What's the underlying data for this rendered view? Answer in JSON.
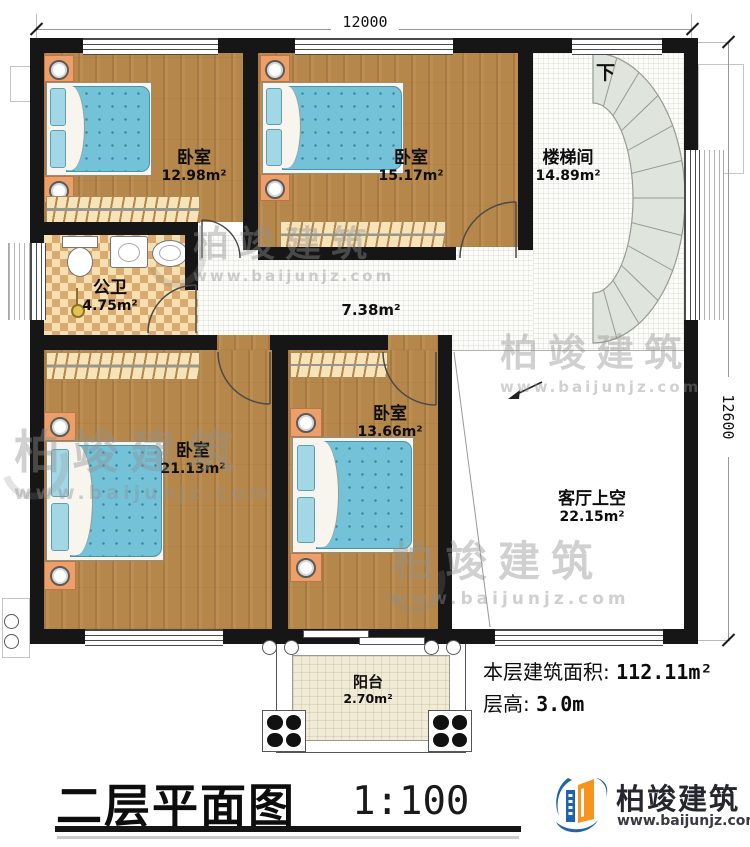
{
  "dimensions": {
    "top": "12000",
    "right": "12600"
  },
  "rooms": {
    "bedroom_tl": {
      "name": "卧室",
      "area": "12.98m²"
    },
    "bedroom_tm": {
      "name": "卧室",
      "area": "15.17m²"
    },
    "stairwell": {
      "name": "楼梯间",
      "area": "14.89m²",
      "direction": "下"
    },
    "bathroom": {
      "name": "公卫",
      "area": "4.75m²"
    },
    "corridor": {
      "area": "7.38m²"
    },
    "bedroom_bl": {
      "name": "卧室",
      "area": "21.13m²"
    },
    "bedroom_bm": {
      "name": "卧室",
      "area": "13.66m²"
    },
    "living_void": {
      "name": "客厅上空",
      "area": "22.15m²"
    },
    "balcony": {
      "name": "阳台",
      "area": "2.70m²"
    }
  },
  "notes": {
    "floor_area_label": "本层建筑面积:",
    "floor_area_value": "112.11m²",
    "floor_height_label": "层高:",
    "floor_height_value": "3.0m"
  },
  "title_block": {
    "title": "二层平面图",
    "scale": "1:100"
  },
  "branding": {
    "company": "柏竣建筑",
    "website": "www.baijunjz.com"
  },
  "watermark": {
    "company": "柏竣建筑",
    "website": "www.baijunjz.com"
  },
  "colors": {
    "wall": "#161616",
    "wood_floor": "#b6874a",
    "mattress": "#74c2d8",
    "stair_fill": "#dfe5dc",
    "bath_tile": "#f5e0b2",
    "logo_blue": "#1e63ad",
    "logo_orange": "#f7941d"
  }
}
